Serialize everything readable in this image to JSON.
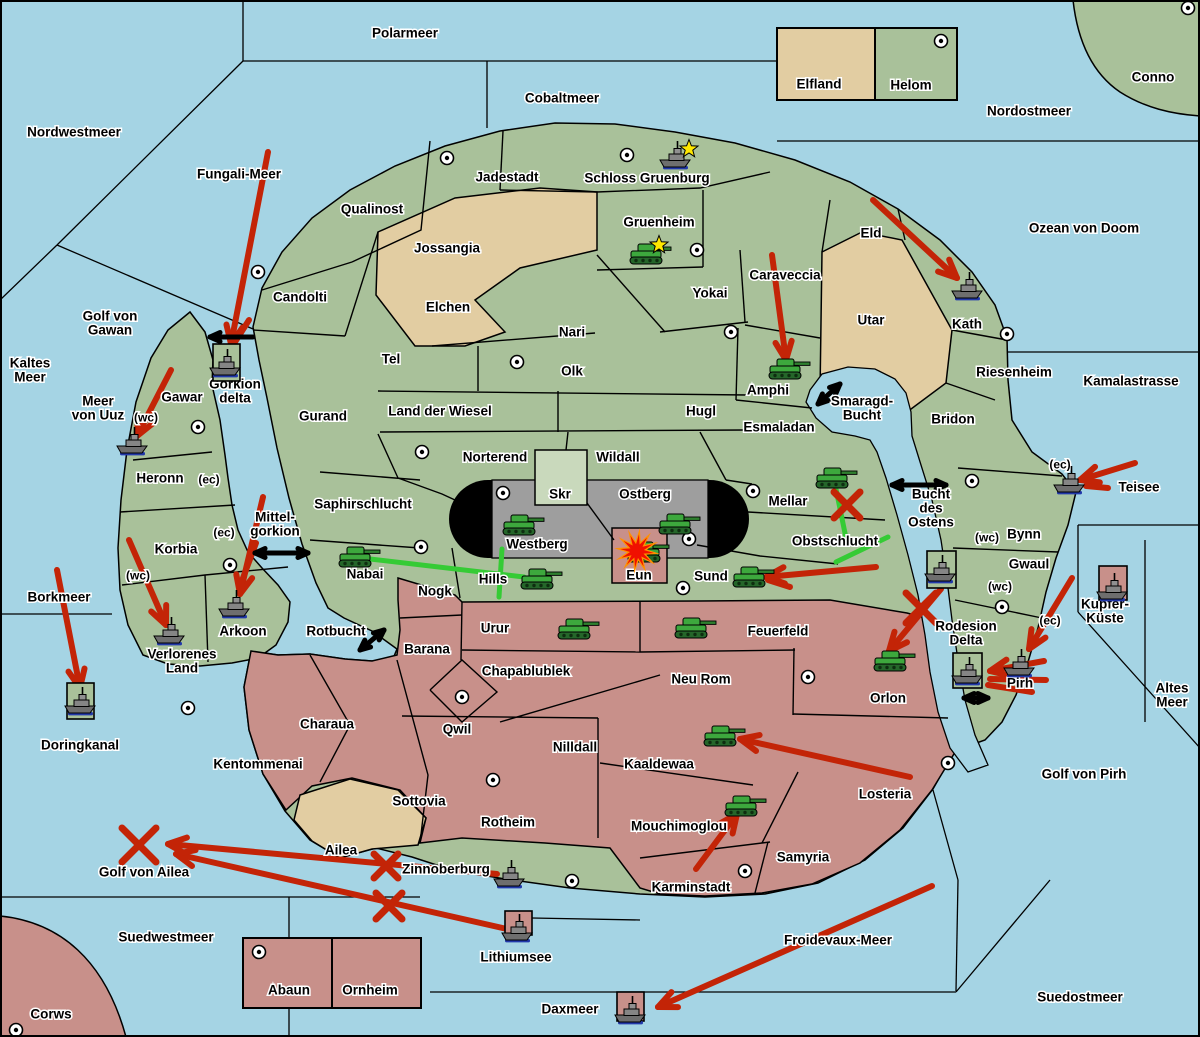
{
  "map": {
    "colors": {
      "sea": "#a5d4e4",
      "land_green": "#a9c19a",
      "land_tan": "#e2cda2",
      "land_pink": "#c8908a",
      "mountain_grey": "#9e9e9e",
      "mountain_cap_black": "#000000",
      "arrow_red": "#c32407",
      "support_green": "#35cb35",
      "strait_black": "#000000",
      "star_yellow": "#ffe800",
      "explosion_orange": "#ff9100",
      "explosion_red": "#f01000",
      "border_black": "#000000",
      "box_fill_skr": "#c9d9bc"
    },
    "sea_labels": [
      {
        "text": "Polarmeer",
        "x": 405,
        "y": 33
      },
      {
        "text": "Cobaltmeer",
        "x": 562,
        "y": 98
      },
      {
        "text": "Nordwestmeer",
        "x": 74,
        "y": 132
      },
      {
        "text": "Fungali-Meer",
        "x": 239,
        "y": 174
      },
      {
        "text": "Nordostmeer",
        "x": 1029,
        "y": 111
      },
      {
        "text": "Ozean von Doom",
        "x": 1084,
        "y": 228
      },
      {
        "lines": [
          "Kaltes",
          "Meer"
        ],
        "x": 30,
        "y": 370
      },
      {
        "lines": [
          "Golf von",
          "Gawan"
        ],
        "x": 110,
        "y": 323
      },
      {
        "lines": [
          "Meer",
          "von Uuz"
        ],
        "x": 98,
        "y": 408
      },
      {
        "text": "Borkmeer",
        "x": 59,
        "y": 597
      },
      {
        "text": "Doringkanal",
        "x": 80,
        "y": 745
      },
      {
        "text": "Golf von Ailea",
        "x": 144,
        "y": 872
      },
      {
        "text": "Suedwestmeer",
        "x": 166,
        "y": 937
      },
      {
        "text": "Daxmeer",
        "x": 570,
        "y": 1009
      },
      {
        "text": "Lithiumsee",
        "x": 516,
        "y": 957
      },
      {
        "text": "Froidevaux-Meer",
        "x": 838,
        "y": 940
      },
      {
        "text": "Suedostmeer",
        "x": 1080,
        "y": 997
      },
      {
        "lines": [
          "Smaragd-",
          "Bucht"
        ],
        "x": 862,
        "y": 408
      },
      {
        "lines": [
          "Bucht",
          "des",
          "Ostens"
        ],
        "x": 931,
        "y": 508
      },
      {
        "lines": [
          "Mittel-",
          "gorkion"
        ],
        "x": 275,
        "y": 524
      },
      {
        "text": "Rotbucht",
        "x": 336,
        "y": 631
      },
      {
        "text": "Kamalastrasse",
        "x": 1131,
        "y": 381
      },
      {
        "text": "Teisee",
        "x": 1139,
        "y": 487
      },
      {
        "lines": [
          "Altes",
          "Meer"
        ],
        "x": 1172,
        "y": 695
      },
      {
        "text": "Golf von Pirh",
        "x": 1084,
        "y": 774
      },
      {
        "lines": [
          "Kupfer-",
          "Küste"
        ],
        "x": 1105,
        "y": 611
      },
      {
        "lines": [
          "Rodesion",
          "Delta"
        ],
        "x": 966,
        "y": 633
      }
    ],
    "land_labels": [
      {
        "text": "Qualinost",
        "x": 372,
        "y": 209
      },
      {
        "text": "Candolti",
        "x": 300,
        "y": 297
      },
      {
        "text": "Jadestadt",
        "x": 507,
        "y": 177
      },
      {
        "text": "Schloss Gruenburg",
        "x": 647,
        "y": 178
      },
      {
        "text": "Gruenheim",
        "x": 659,
        "y": 222
      },
      {
        "text": "Jossangia",
        "x": 447,
        "y": 248
      },
      {
        "text": "Elchen",
        "x": 448,
        "y": 307
      },
      {
        "text": "Yokai",
        "x": 710,
        "y": 293
      },
      {
        "text": "Caraveccia",
        "x": 785,
        "y": 275
      },
      {
        "text": "Eld",
        "x": 871,
        "y": 233
      },
      {
        "text": "Utar",
        "x": 871,
        "y": 320
      },
      {
        "text": "Kath",
        "x": 967,
        "y": 324
      },
      {
        "text": "Riesenheim",
        "x": 1014,
        "y": 372
      },
      {
        "text": "Bridon",
        "x": 953,
        "y": 419
      },
      {
        "text": "Conno",
        "x": 1153,
        "y": 77
      },
      {
        "text": "Elfland",
        "x": 819,
        "y": 84
      },
      {
        "text": "Helom",
        "x": 911,
        "y": 85
      },
      {
        "text": "Nari",
        "x": 572,
        "y": 332
      },
      {
        "text": "Tel",
        "x": 391,
        "y": 359
      },
      {
        "text": "Olk",
        "x": 572,
        "y": 371
      },
      {
        "text": "Gurand",
        "x": 323,
        "y": 416
      },
      {
        "text": "Land der Wiesel",
        "x": 440,
        "y": 411
      },
      {
        "text": "Hugl",
        "x": 701,
        "y": 411
      },
      {
        "text": "Esmaladan",
        "x": 779,
        "y": 427
      },
      {
        "text": "Amphi",
        "x": 768,
        "y": 390
      },
      {
        "text": "Norterend",
        "x": 495,
        "y": 457
      },
      {
        "text": "Wildall",
        "x": 618,
        "y": 457
      },
      {
        "text": "Skr",
        "x": 560,
        "y": 494
      },
      {
        "text": "Ostberg",
        "x": 645,
        "y": 494
      },
      {
        "text": "Westberg",
        "x": 537,
        "y": 544
      },
      {
        "text": "Mellar",
        "x": 788,
        "y": 501
      },
      {
        "text": "Obstschlucht",
        "x": 835,
        "y": 541
      },
      {
        "text": "Saphirschlucht",
        "x": 363,
        "y": 504
      },
      {
        "text": "Heronn",
        "x": 160,
        "y": 478
      },
      {
        "text": "Gawar",
        "x": 182,
        "y": 397
      },
      {
        "lines": [
          "Gorkion",
          "delta"
        ],
        "x": 235,
        "y": 391
      },
      {
        "text": "Korbia",
        "x": 176,
        "y": 549
      },
      {
        "text": "Nabai",
        "x": 365,
        "y": 574
      },
      {
        "text": "Hills",
        "x": 493,
        "y": 579
      },
      {
        "lines": [
          "Verlorenes",
          "Land"
        ],
        "x": 182,
        "y": 661
      },
      {
        "text": "Arkoon",
        "x": 243,
        "y": 631
      },
      {
        "text": "Nogk",
        "x": 435,
        "y": 591
      },
      {
        "text": "Barana",
        "x": 427,
        "y": 649
      },
      {
        "text": "Urur",
        "x": 495,
        "y": 628
      },
      {
        "text": "Chapablublek",
        "x": 526,
        "y": 671
      },
      {
        "text": "Neu Rom",
        "x": 701,
        "y": 679
      },
      {
        "text": "Feuerfeld",
        "x": 778,
        "y": 631
      },
      {
        "text": "Qwil",
        "x": 457,
        "y": 729
      },
      {
        "text": "Nilldall",
        "x": 575,
        "y": 747
      },
      {
        "text": "Kaaldewaa",
        "x": 659,
        "y": 764
      },
      {
        "text": "Sottovia",
        "x": 419,
        "y": 801
      },
      {
        "text": "Rotheim",
        "x": 508,
        "y": 822
      },
      {
        "text": "Mouchimoglou",
        "x": 679,
        "y": 826
      },
      {
        "text": "Karminstadt",
        "x": 691,
        "y": 887
      },
      {
        "text": "Samyria",
        "x": 803,
        "y": 857
      },
      {
        "text": "Losteria",
        "x": 885,
        "y": 794
      },
      {
        "text": "Orlon",
        "x": 888,
        "y": 698
      },
      {
        "text": "Charaua",
        "x": 327,
        "y": 724
      },
      {
        "text": "Kentommenai",
        "x": 258,
        "y": 764
      },
      {
        "text": "Ailea",
        "x": 341,
        "y": 850
      },
      {
        "text": "Eun",
        "x": 639,
        "y": 575
      },
      {
        "text": "Sund",
        "x": 711,
        "y": 576
      },
      {
        "text": "Zinnoberburg",
        "x": 446,
        "y": 869
      },
      {
        "text": "Abaun",
        "x": 289,
        "y": 990
      },
      {
        "text": "Ornheim",
        "x": 370,
        "y": 990
      },
      {
        "text": "Corws",
        "x": 51,
        "y": 1014
      },
      {
        "text": "Bynn",
        "x": 1024,
        "y": 534
      },
      {
        "text": "Gwaul",
        "x": 1029,
        "y": 564
      },
      {
        "text": "Pirh",
        "x": 1020,
        "y": 683
      }
    ],
    "coast_markers": [
      {
        "text": "(wc)",
        "x": 146,
        "y": 417
      },
      {
        "text": "(ec)",
        "x": 209,
        "y": 479
      },
      {
        "text": "(ec)",
        "x": 224,
        "y": 532
      },
      {
        "text": "(wc)",
        "x": 138,
        "y": 575
      },
      {
        "text": "(ec)",
        "x": 1060,
        "y": 464
      },
      {
        "text": "(wc)",
        "x": 987,
        "y": 537
      },
      {
        "text": "(wc)",
        "x": 1000,
        "y": 586
      },
      {
        "text": "(ec)",
        "x": 1050,
        "y": 620
      }
    ],
    "supply_centers": [
      [
        258,
        272
      ],
      [
        447,
        158
      ],
      [
        627,
        155
      ],
      [
        697,
        250
      ],
      [
        731,
        332
      ],
      [
        1007,
        334
      ],
      [
        1188,
        8
      ],
      [
        941,
        41
      ],
      [
        517,
        362
      ],
      [
        198,
        427
      ],
      [
        422,
        452
      ],
      [
        503,
        493
      ],
      [
        689,
        539
      ],
      [
        753,
        491
      ],
      [
        421,
        547
      ],
      [
        230,
        565
      ],
      [
        188,
        708
      ],
      [
        462,
        697
      ],
      [
        493,
        780
      ],
      [
        745,
        871
      ],
      [
        948,
        763
      ],
      [
        808,
        677
      ],
      [
        683,
        588
      ],
      [
        572,
        881
      ],
      [
        972,
        481
      ],
      [
        1002,
        607
      ],
      [
        16,
        1030
      ],
      [
        259,
        952
      ]
    ],
    "armies": [
      {
        "x": 646,
        "y": 254,
        "star": true
      },
      {
        "x": 785,
        "y": 369
      },
      {
        "x": 519,
        "y": 525
      },
      {
        "x": 675,
        "y": 524
      },
      {
        "x": 355,
        "y": 557
      },
      {
        "x": 537,
        "y": 579
      },
      {
        "x": 574,
        "y": 629
      },
      {
        "x": 691,
        "y": 628
      },
      {
        "x": 832,
        "y": 478
      },
      {
        "x": 749,
        "y": 577
      },
      {
        "x": 720,
        "y": 736
      },
      {
        "x": 741,
        "y": 806
      },
      {
        "x": 890,
        "y": 661
      },
      {
        "x": 644,
        "y": 552
      }
    ],
    "fleets": [
      {
        "x": 676,
        "y": 158,
        "star": true
      },
      {
        "x": 968,
        "y": 289
      },
      {
        "x": 226,
        "y": 366,
        "box": {
          "x": 213,
          "y": 344,
          "w": 27,
          "h": 37,
          "fill": "green"
        }
      },
      {
        "x": 133,
        "y": 444
      },
      {
        "x": 1070,
        "y": 483
      },
      {
        "x": 235,
        "y": 607
      },
      {
        "x": 170,
        "y": 634
      },
      {
        "x": 81,
        "y": 704,
        "box": {
          "x": 67,
          "y": 683,
          "w": 27,
          "h": 36,
          "fill": "green"
        }
      },
      {
        "x": 941,
        "y": 572,
        "box": {
          "x": 927,
          "y": 551,
          "w": 29,
          "h": 37,
          "fill": "green"
        }
      },
      {
        "x": 968,
        "y": 674,
        "box": {
          "x": 953,
          "y": 653,
          "w": 29,
          "h": 35,
          "fill": "green"
        }
      },
      {
        "x": 1020,
        "y": 666
      },
      {
        "x": 1113,
        "y": 590,
        "box": {
          "x": 1099,
          "y": 566,
          "w": 28,
          "h": 34,
          "fill": "pink"
        }
      },
      {
        "x": 510,
        "y": 877
      },
      {
        "x": 518,
        "y": 931,
        "box": {
          "x": 505,
          "y": 911,
          "w": 27,
          "h": 24,
          "fill": "pink"
        }
      },
      {
        "x": 631,
        "y": 1013,
        "box": {
          "x": 617,
          "y": 992,
          "w": 27,
          "h": 29,
          "fill": "pink"
        }
      }
    ],
    "red_arrows": [
      {
        "from": [
          268,
          152
        ],
        "to": [
          231,
          344
        ]
      },
      {
        "from": [
          171,
          370
        ],
        "to": [
          137,
          436
        ]
      },
      {
        "from": [
          873,
          200
        ],
        "to": [
          957,
          278
        ]
      },
      {
        "from": [
          772,
          255
        ],
        "to": [
          786,
          360
        ]
      },
      {
        "from": [
          57,
          570
        ],
        "to": [
          80,
          688
        ]
      },
      {
        "from": [
          129,
          540
        ],
        "to": [
          166,
          625
        ]
      },
      {
        "from": [
          263,
          497
        ],
        "to": [
          240,
          594
        ]
      },
      {
        "from": [
          876,
          567
        ],
        "to": [
          766,
          577
        ]
      },
      {
        "from": [
          941,
          589
        ],
        "to": [
          889,
          651
        ]
      },
      {
        "from": [
          910,
          777
        ],
        "to": [
          740,
          739
        ]
      },
      {
        "from": [
          696,
          869
        ],
        "to": [
          737,
          814
        ]
      },
      {
        "from": [
          932,
          886
        ],
        "to": [
          658,
          1007
        ]
      },
      {
        "from": [
          497,
          874
        ],
        "to": [
          168,
          844
        ]
      },
      {
        "from": [
          507,
          929
        ],
        "to": [
          176,
          854
        ]
      },
      {
        "from": [
          1135,
          463
        ],
        "to": [
          1080,
          480
        ]
      },
      {
        "from": [
          1072,
          578
        ],
        "to": [
          1029,
          649
        ]
      },
      {
        "from": [
          1044,
          661
        ],
        "to": [
          990,
          671
        ]
      }
    ],
    "red_strokes": [
      [
        256,
        543,
        240,
        586
      ],
      [
        1108,
        488,
        1086,
        486
      ],
      [
        1046,
        680,
        990,
        679
      ],
      [
        1032,
        692,
        988,
        685
      ],
      [
        790,
        587,
        768,
        580
      ],
      [
        249,
        320,
        235,
        342
      ]
    ],
    "crosses": [
      {
        "x": 139,
        "y": 845,
        "size": 34
      },
      {
        "x": 386,
        "y": 866,
        "size": 24
      },
      {
        "x": 389,
        "y": 906,
        "size": 26
      },
      {
        "x": 921,
        "y": 608,
        "size": 30
      },
      {
        "x": 847,
        "y": 505,
        "size": 26
      }
    ],
    "green_lines": [
      [
        370,
        559,
        524,
        577
      ],
      [
        502,
        549,
        499,
        597
      ],
      [
        836,
        489,
        847,
        543
      ],
      [
        888,
        537,
        836,
        562
      ]
    ],
    "black_arrows": [
      {
        "x1": 253,
        "y1": 337,
        "x2": 210,
        "y2": 337,
        "double": false
      },
      {
        "x1": 255,
        "y1": 553,
        "x2": 308,
        "y2": 553,
        "double": true
      },
      {
        "x1": 818,
        "y1": 404,
        "x2": 840,
        "y2": 384,
        "double": true
      },
      {
        "x1": 892,
        "y1": 485,
        "x2": 946,
        "y2": 485,
        "double": true
      },
      {
        "x1": 360,
        "y1": 650,
        "x2": 384,
        "y2": 630,
        "double": true
      },
      {
        "x1": 964,
        "y1": 698,
        "x2": 988,
        "y2": 698,
        "double": true
      }
    ],
    "explosion": {
      "x": 637,
      "y": 551
    }
  }
}
